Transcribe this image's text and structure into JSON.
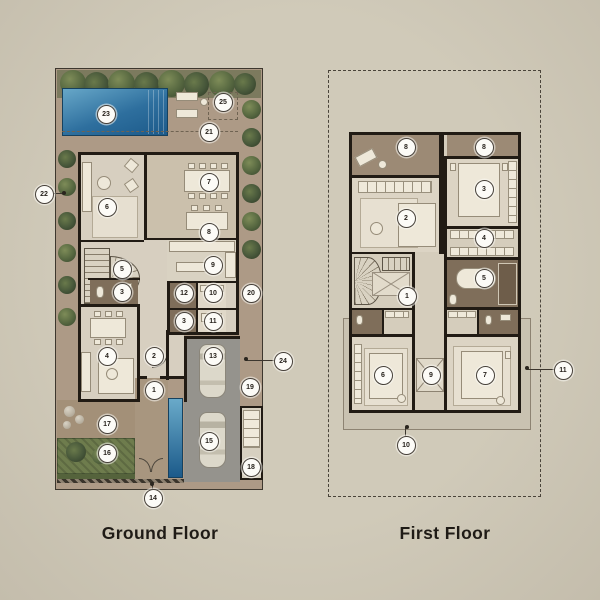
{
  "sheet": {
    "type": "architectural-floor-plan",
    "floors": 2
  },
  "titles": {
    "ground": "Ground Floor",
    "first": "First Floor"
  },
  "colors": {
    "page_background": "#cdc7b6",
    "wall": "#211b14",
    "interior_floor": "#d7cfc0",
    "outdoor_paving": "#ad9a86",
    "dark_room": "#7f6e5a",
    "balcony": "#9c8a75",
    "garage": "#95938d",
    "pool_top": "#5e9ec2",
    "pool_bottom": "#1e5c8c",
    "greenery": "#566740",
    "marker_background": "#fcfbf7",
    "marker_border": "#47413a",
    "title_text": "#1f1b16"
  },
  "ground_floor": {
    "label": "Ground Floor",
    "markers": [
      {
        "n": "23",
        "x": 105,
        "y": 113
      },
      {
        "n": "25",
        "x": 222,
        "y": 101
      },
      {
        "n": "21",
        "x": 208,
        "y": 131
      },
      {
        "n": "22",
        "x": 43,
        "y": 193,
        "t": {
          "x": 64,
          "y": 193
        }
      },
      {
        "n": "6",
        "x": 106,
        "y": 206
      },
      {
        "n": "7",
        "x": 208,
        "y": 181
      },
      {
        "n": "8",
        "x": 208,
        "y": 231
      },
      {
        "n": "9",
        "x": 212,
        "y": 264
      },
      {
        "n": "5",
        "x": 121,
        "y": 268
      },
      {
        "n": "3",
        "x": 121,
        "y": 291
      },
      {
        "n": "12",
        "x": 183,
        "y": 292
      },
      {
        "n": "10",
        "x": 212,
        "y": 292
      },
      {
        "n": "20",
        "x": 250,
        "y": 292
      },
      {
        "n": "3",
        "x": 183,
        "y": 320
      },
      {
        "n": "11",
        "x": 212,
        "y": 320
      },
      {
        "n": "4",
        "x": 106,
        "y": 355
      },
      {
        "n": "2",
        "x": 153,
        "y": 355
      },
      {
        "n": "13",
        "x": 212,
        "y": 355
      },
      {
        "n": "24",
        "x": 282,
        "y": 360,
        "t": {
          "x": 246,
          "y": 359
        }
      },
      {
        "n": "1",
        "x": 153,
        "y": 389
      },
      {
        "n": "19",
        "x": 249,
        "y": 386
      },
      {
        "n": "17",
        "x": 106,
        "y": 423
      },
      {
        "n": "16",
        "x": 106,
        "y": 452
      },
      {
        "n": "15",
        "x": 208,
        "y": 440
      },
      {
        "n": "18",
        "x": 250,
        "y": 466
      },
      {
        "n": "14",
        "x": 152,
        "y": 497,
        "t": {
          "x": 152,
          "y": 484
        }
      }
    ]
  },
  "first_floor": {
    "label": "First Floor",
    "markers": [
      {
        "n": "8",
        "x": 405,
        "y": 146
      },
      {
        "n": "8",
        "x": 483,
        "y": 146
      },
      {
        "n": "3",
        "x": 483,
        "y": 188
      },
      {
        "n": "2",
        "x": 405,
        "y": 217
      },
      {
        "n": "4",
        "x": 483,
        "y": 237
      },
      {
        "n": "5",
        "x": 483,
        "y": 277
      },
      {
        "n": "1",
        "x": 406,
        "y": 295
      },
      {
        "n": "6",
        "x": 382,
        "y": 374
      },
      {
        "n": "9",
        "x": 430,
        "y": 374
      },
      {
        "n": "7",
        "x": 484,
        "y": 374
      },
      {
        "n": "11",
        "x": 562,
        "y": 369,
        "t": {
          "x": 527,
          "y": 368
        }
      },
      {
        "n": "10",
        "x": 405,
        "y": 444,
        "t": {
          "x": 407,
          "y": 427
        }
      }
    ]
  }
}
